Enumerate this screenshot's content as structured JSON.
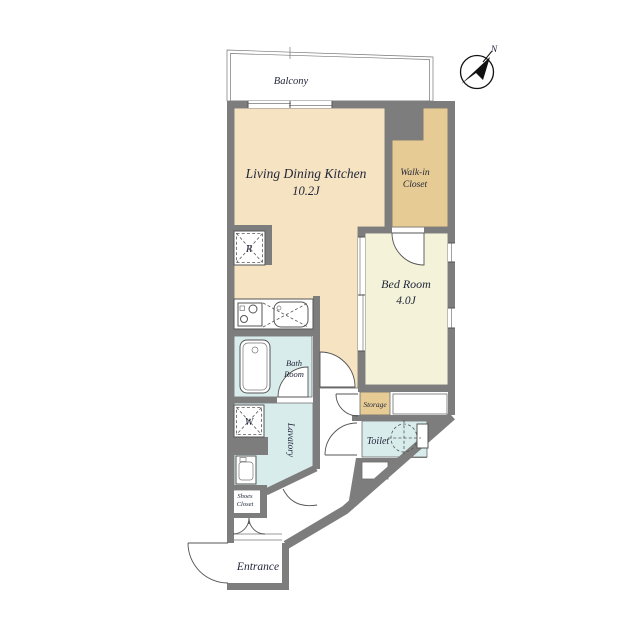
{
  "rooms": {
    "balcony": {
      "label": "Balcony"
    },
    "ldk": {
      "label": "Living Dining Kitchen",
      "size": "10.2J"
    },
    "walk_in_closet": {
      "line1": "Walk-in",
      "line2": "Closet"
    },
    "bedroom": {
      "label": "Bed Room",
      "size": "4.0J"
    },
    "bathroom": {
      "line1": "Bath",
      "line2": "Room"
    },
    "lavatory": {
      "label": "Lavatory"
    },
    "toilet": {
      "label": "Toilet"
    },
    "storage": {
      "label": "Storage"
    },
    "shoes_closet": {
      "line1": "Shoes",
      "line2": "Closet"
    },
    "entrance": {
      "label": "Entrance"
    }
  },
  "fixtures": {
    "refrigerator_mark": "R",
    "washer_mark": "W"
  },
  "compass": {
    "north_label": "N"
  },
  "colors": {
    "wall": "#7d7d7d",
    "ldk": "#f5e3c2",
    "closet": "#e6cb94",
    "bedroom": "#f4f3da",
    "wet": "#d9ecec",
    "text": "#23273a"
  }
}
